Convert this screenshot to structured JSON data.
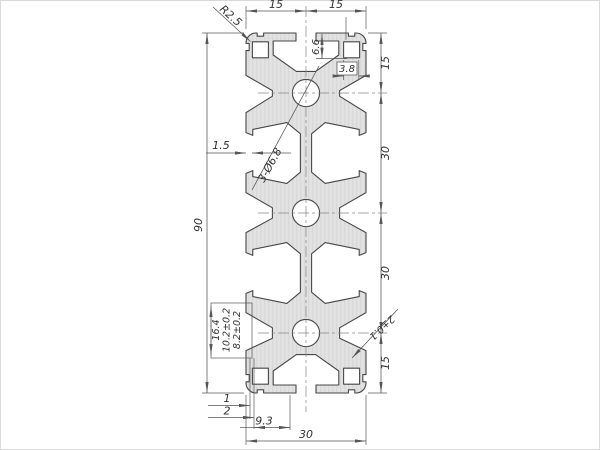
{
  "drawing": {
    "type": "technical-cross-section",
    "subject": "aluminium-extrusion-profile-30x90",
    "colors": {
      "background": "#ffffff",
      "profile_fill": "#e2e2e2",
      "profile_stroke": "#474747",
      "dimension_lines": "#555555",
      "text": "#333333"
    },
    "dims": {
      "top_left": "15",
      "top_right": "15",
      "right_1": "15",
      "right_2": "30",
      "right_3": "30",
      "right_4": "15",
      "overall_height": "90",
      "wall_thickness": "1.5",
      "corner_radius": "R2.5",
      "holes_callout": "3-Ø6.8",
      "slot_depth": "6.6",
      "chamber_width": "3.8",
      "slot_opening": "8.2±0.2",
      "slot_mid_width": "10.2±0.2",
      "slot_inner_width": "16.4",
      "lip_1": "1",
      "lip_2": "2",
      "slot_offset": "9.3",
      "overall_width": "30",
      "lip_tolerance": "2±0.1"
    }
  }
}
